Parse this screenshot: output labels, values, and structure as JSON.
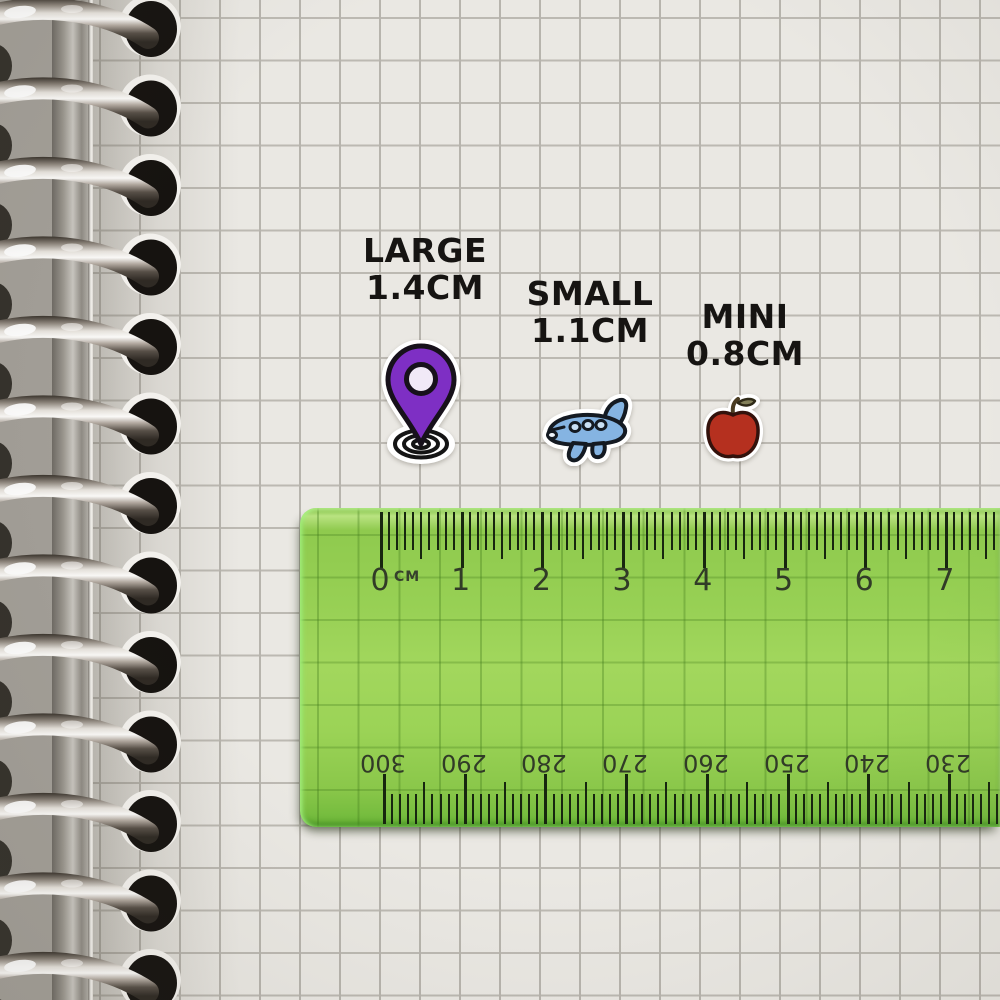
{
  "stickers": [
    {
      "size_name": "LARGE",
      "size_value": "1.4CM",
      "icon": "location-pin-sticker"
    },
    {
      "size_name": "SMALL",
      "size_value": "1.1CM",
      "icon": "airplane-sticker"
    },
    {
      "size_name": "MINI",
      "size_value": "0.8CM",
      "icon": "apple-sticker"
    }
  ],
  "ruler": {
    "unit_label": "CM",
    "top_scale_numbers": [
      "0",
      "1",
      "2",
      "3",
      "4",
      "5",
      "6",
      "7"
    ],
    "bottom_scale_numbers": [
      "300",
      "290",
      "280",
      "270",
      "260",
      "250",
      "240",
      "230"
    ]
  },
  "colors": {
    "paper": "#eae8e3",
    "grid_line": "#b7b4ad",
    "ruler_green": "#97d054",
    "ruler_tick": "#17260f",
    "label_text": "#161412",
    "pin_purple": "#7e2fc4",
    "plane_blue": "#85b4e2",
    "apple_red": "#b5301f",
    "binding_metal": "#d8d4cf"
  }
}
